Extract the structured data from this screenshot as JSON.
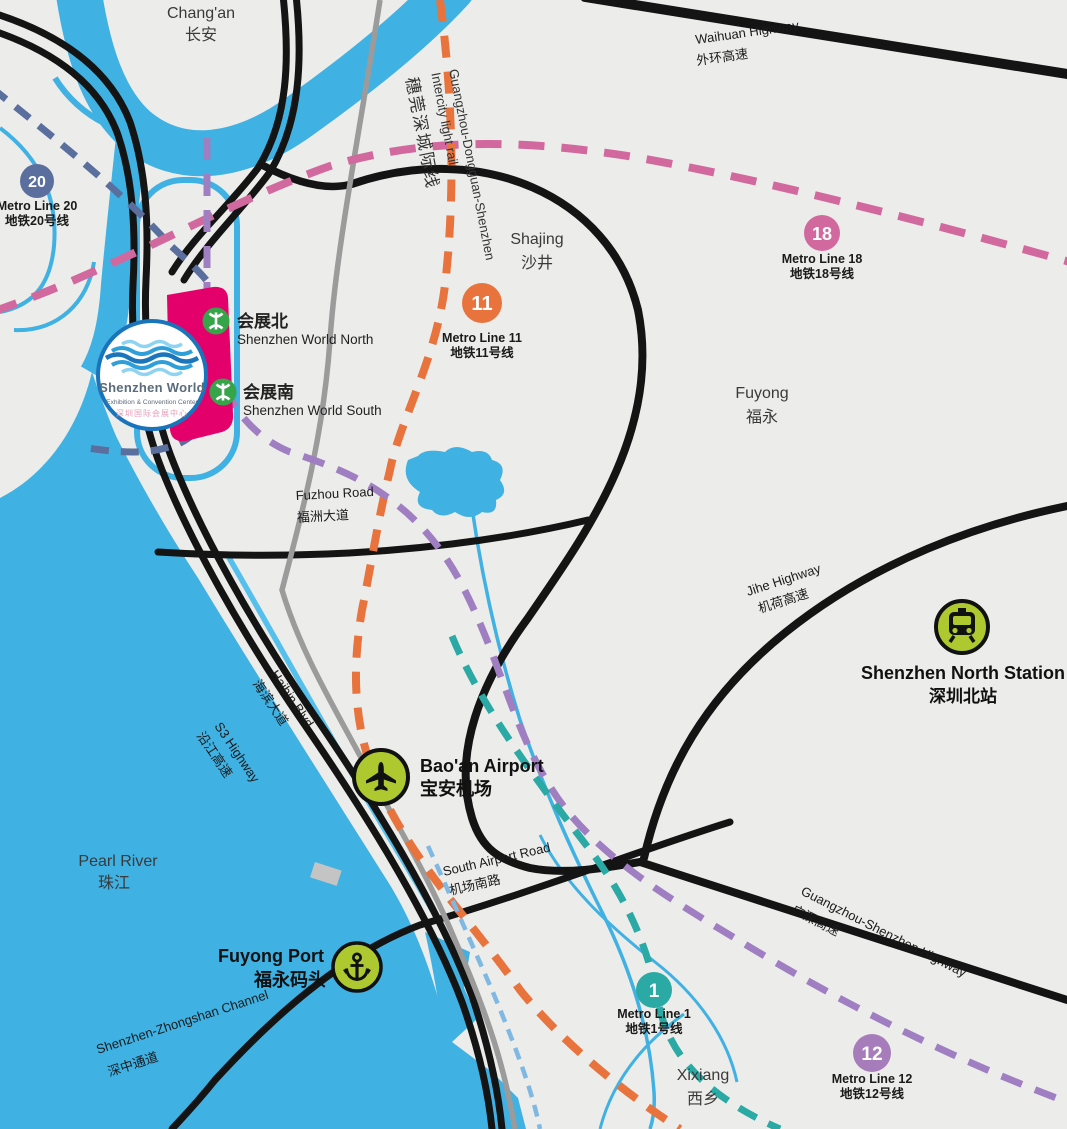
{
  "colors": {
    "water": "#3FB1E3",
    "land": "#ECECEA",
    "road": "#141414",
    "rail": "#9B9B9B",
    "line20": "#5B6F9E",
    "line18": "#D2699E",
    "line11": "#E8733D",
    "line12": "#A07EC2",
    "line1": "#2BA9A4",
    "airport_express_dash": "#7FB8E2",
    "poi_green": "#ADC92F",
    "station_green": "#36A449",
    "venue_pink": "#E4006A",
    "logo_blue": "#1A74BB"
  },
  "areas": [
    {
      "en": "Chang'an",
      "zh": "长安"
    },
    {
      "en": "Shajing",
      "zh": "沙井"
    },
    {
      "en": "Fuyong",
      "zh": "福永"
    },
    {
      "en": "Xixiang",
      "zh": "西乡"
    },
    {
      "en": "Pearl River",
      "zh": "珠江"
    }
  ],
  "roads": [
    {
      "en": "Waihuan Highway",
      "zh": "外环高速"
    },
    {
      "en": "Fuzhou Road",
      "zh": "福洲大道"
    },
    {
      "en": "Jihe Highway",
      "zh": "机荷高速"
    },
    {
      "en": "Haibin Blvd",
      "zh": "海滨大道"
    },
    {
      "en": "S3 Highway",
      "zh": "沿江高速"
    },
    {
      "en": "South Airport Road",
      "zh": "机场南路"
    },
    {
      "en": "Guangzhou-Shenzhen Highway",
      "zh": "广深高速"
    },
    {
      "en": "Shenzhen-Zhongshan Channel",
      "zh": "深中通道"
    }
  ],
  "rail": {
    "en_line1": "Guangzhou-Dongguan-Shenzhen",
    "en_line2": "Intercity light rail",
    "zh": "穗莞深城际线"
  },
  "metro_lines": [
    {
      "num": "20",
      "en": "Metro Line 20",
      "zh": "地铁20号线"
    },
    {
      "num": "18",
      "en": "Metro Line 18",
      "zh": "地铁18号线"
    },
    {
      "num": "11",
      "en": "Metro Line 11",
      "zh": "地铁11号线"
    },
    {
      "num": "1",
      "en": "Metro Line 1",
      "zh": "地铁1号线"
    },
    {
      "num": "12",
      "en": "Metro Line 12",
      "zh": "地铁12号线"
    }
  ],
  "stations": [
    {
      "zh": "会展北",
      "en": "Shenzhen World North"
    },
    {
      "zh": "会展南",
      "en": "Shenzhen World South"
    }
  ],
  "pois": [
    {
      "en": "Bao'an Airport",
      "zh": "宝安机场"
    },
    {
      "en": "Shenzhen North Station",
      "zh": "深圳北站"
    },
    {
      "en": "Fuyong Port",
      "zh": "福永码头"
    }
  ],
  "logo": {
    "line1": "Shenzhen World",
    "line2": "Exhibition & Convention Center",
    "line3": "深圳国际会展中心"
  }
}
